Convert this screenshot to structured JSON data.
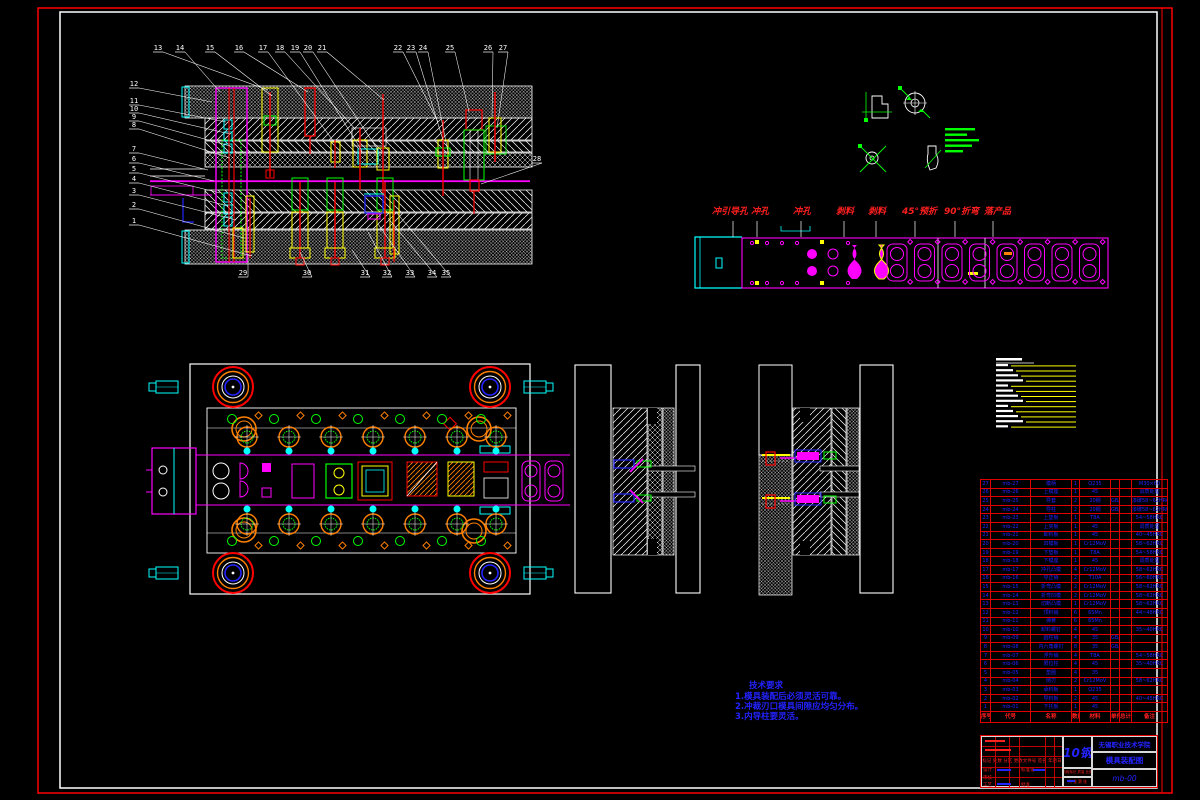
{
  "page": {
    "bg": "#000000",
    "border_color": "#ff0000",
    "frame_color": "#ffffff"
  },
  "colors": {
    "red": "#ff0000",
    "magenta": "#ff00ff",
    "cyan": "#00ffff",
    "green": "#00ff00",
    "yellow": "#ffff00",
    "blue": "#2323ff",
    "orange": "#ff8000",
    "white": "#ffffff"
  },
  "annotations": {
    "balloons": [
      {
        "n": "13",
        "x": 158,
        "y": 50,
        "tx": 268,
        "ty": 90
      },
      {
        "n": "14",
        "x": 180,
        "y": 50,
        "tx": 220,
        "ty": 92
      },
      {
        "n": "15",
        "x": 210,
        "y": 50,
        "tx": 272,
        "ty": 96
      },
      {
        "n": "16",
        "x": 239,
        "y": 50,
        "tx": 308,
        "ty": 92
      },
      {
        "n": "17",
        "x": 263,
        "y": 50,
        "tx": 334,
        "ty": 142
      },
      {
        "n": "18",
        "x": 280,
        "y": 50,
        "tx": 356,
        "ty": 130
      },
      {
        "n": "19",
        "x": 295,
        "y": 50,
        "tx": 362,
        "ty": 151
      },
      {
        "n": "20",
        "x": 308,
        "y": 50,
        "tx": 378,
        "ty": 150
      },
      {
        "n": "21",
        "x": 322,
        "y": 50,
        "tx": 384,
        "ty": 100
      },
      {
        "n": "22",
        "x": 398,
        "y": 50,
        "tx": 438,
        "ty": 122
      },
      {
        "n": "23",
        "x": 411,
        "y": 50,
        "tx": 443,
        "ty": 140
      },
      {
        "n": "24",
        "x": 423,
        "y": 50,
        "tx": 448,
        "ty": 152
      },
      {
        "n": "25",
        "x": 450,
        "y": 50,
        "tx": 469,
        "ty": 112
      },
      {
        "n": "26",
        "x": 488,
        "y": 50,
        "tx": 492,
        "ty": 118
      },
      {
        "n": "27",
        "x": 503,
        "y": 50,
        "tx": 497,
        "ty": 128
      },
      {
        "n": "28",
        "x": 537,
        "y": 161,
        "tx": 481,
        "ty": 184
      },
      {
        "n": "12",
        "x": 134,
        "y": 86,
        "tx": 212,
        "ty": 102
      },
      {
        "n": "11",
        "x": 134,
        "y": 103,
        "tx": 226,
        "ty": 122
      },
      {
        "n": "10",
        "x": 134,
        "y": 111,
        "tx": 230,
        "ty": 134
      },
      {
        "n": "9",
        "x": 134,
        "y": 119,
        "tx": 230,
        "ty": 146
      },
      {
        "n": "8",
        "x": 134,
        "y": 127,
        "tx": 230,
        "ty": 158
      },
      {
        "n": "7",
        "x": 134,
        "y": 151,
        "tx": 208,
        "ty": 170
      },
      {
        "n": "6",
        "x": 134,
        "y": 161,
        "tx": 214,
        "ty": 181
      },
      {
        "n": "5",
        "x": 134,
        "y": 171,
        "tx": 220,
        "ty": 193
      },
      {
        "n": "4",
        "x": 134,
        "y": 181,
        "tx": 228,
        "ty": 206
      },
      {
        "n": "3",
        "x": 134,
        "y": 193,
        "tx": 236,
        "ty": 220
      },
      {
        "n": "2",
        "x": 134,
        "y": 207,
        "tx": 244,
        "ty": 238
      },
      {
        "n": "1",
        "x": 134,
        "y": 223,
        "tx": 252,
        "ty": 256
      },
      {
        "n": "29",
        "x": 243,
        "y": 275,
        "tx": 248,
        "ty": 254
      },
      {
        "n": "30",
        "x": 307,
        "y": 275,
        "tx": 300,
        "ty": 252
      },
      {
        "n": "31",
        "x": 365,
        "y": 275,
        "tx": 352,
        "ty": 250
      },
      {
        "n": "32",
        "x": 387,
        "y": 275,
        "tx": 368,
        "ty": 232
      },
      {
        "n": "33",
        "x": 410,
        "y": 275,
        "tx": 378,
        "ty": 224
      },
      {
        "n": "34",
        "x": 432,
        "y": 275,
        "tx": 388,
        "ty": 218
      },
      {
        "n": "35",
        "x": 446,
        "y": 275,
        "tx": 396,
        "ty": 212
      }
    ],
    "strip_labels": [
      {
        "text": "冲引导孔 冲孔",
        "x": 712,
        "lx": 757
      },
      {
        "text": "冲孔",
        "x": 793,
        "lx": 801
      },
      {
        "text": "剥料",
        "x": 836,
        "lx": 844
      },
      {
        "text": "剥料",
        "x": 868,
        "lx": 876
      },
      {
        "text": "45°预折",
        "x": 902,
        "lx": 915
      },
      {
        "text": "90°折弯",
        "x": 944,
        "lx": 955
      },
      {
        "text": "落产品",
        "x": 984,
        "lx": 993
      }
    ],
    "notes": {
      "title": "技术要求",
      "lines": [
        "1.模具装配后必须灵活可靠。",
        "2.冲裁刃口模具间隙应均匀分布。",
        "3.内导柱要灵活。"
      ]
    }
  },
  "legend": {
    "row_count": 13
  },
  "bom": {
    "headers": [
      "序号",
      "代号",
      "名称",
      "数量",
      "材料",
      "单件",
      "总计",
      "备注"
    ],
    "rows": [
      [
        "27",
        "mb-27",
        "模柄",
        "1",
        "Q235",
        "",
        "",
        "M30×60"
      ],
      [
        "26",
        "mb-26",
        "上模座",
        "1",
        "45",
        "",
        "",
        "调质处理"
      ],
      [
        "25",
        "mb-25",
        "导套",
        "2",
        "20钢",
        "GB/T 2861",
        "",
        "渗碳58~62HRC"
      ],
      [
        "24",
        "mb-24",
        "导柱",
        "2",
        "20钢",
        "GB/T 2861",
        "",
        "渗碳58~62HRC"
      ],
      [
        "23",
        "mb-23",
        "上垫板",
        "1",
        "T8A",
        "",
        "",
        "54~58HRC"
      ],
      [
        "22",
        "mb-22",
        "上夹板",
        "1",
        "45",
        "",
        "",
        "调质处理"
      ],
      [
        "21",
        "mb-21",
        "卸料板",
        "1",
        "45",
        "",
        "",
        "40~45HRC"
      ],
      [
        "20",
        "mb-20",
        "凹模板",
        "1",
        "Cr12MoV",
        "",
        "",
        "58~62HRC"
      ],
      [
        "19",
        "mb-19",
        "下垫板",
        "1",
        "T8A",
        "",
        "",
        "54~58HRC"
      ],
      [
        "18",
        "mb-18",
        "下模座",
        "1",
        "45",
        "",
        "",
        "调质处理"
      ],
      [
        "17",
        "mb-17",
        "冲孔凸模",
        "4",
        "Cr12MoV",
        "",
        "",
        "58~62HRC"
      ],
      [
        "16",
        "mb-16",
        "导正销",
        "2",
        "T10A",
        "",
        "",
        "56~60HRC"
      ],
      [
        "15",
        "mb-15",
        "折弯凸模",
        "2",
        "Cr12MoV",
        "",
        "",
        "58~62HRC"
      ],
      [
        "14",
        "mb-14",
        "折弯凹模",
        "2",
        "Cr12MoV",
        "",
        "",
        "58~62HRC"
      ],
      [
        "13",
        "mb-13",
        "切断凸模",
        "1",
        "Cr12MoV",
        "",
        "",
        "58~62HRC"
      ],
      [
        "12",
        "mb-12",
        "顶料销",
        "6",
        "65Mn",
        "",
        "",
        "44~48HRC"
      ],
      [
        "11",
        "mb-11",
        "弹簧",
        "6",
        "65Mn",
        "",
        "",
        ""
      ],
      [
        "10",
        "mb-10",
        "卸料螺钉",
        "4",
        "45",
        "",
        "",
        "35~40HRC"
      ],
      [
        "9",
        "mb-09",
        "圆柱销",
        "4",
        "35",
        "GB/T 119.1",
        "",
        ""
      ],
      [
        "8",
        "mb-08",
        "内六角螺钉",
        "8",
        "35",
        "GB/T 70.1",
        "",
        ""
      ],
      [
        "7",
        "mb-07",
        "浮升销",
        "4",
        "T8A",
        "",
        "",
        "54~58HRC"
      ],
      [
        "6",
        "mb-06",
        "限位柱",
        "4",
        "45",
        "",
        "",
        "35~40HRC"
      ],
      [
        "5",
        "mb-05",
        "垫圈",
        "4",
        "35",
        "",
        "",
        ""
      ],
      [
        "4",
        "mb-04",
        "侧刃",
        "2",
        "Cr12MoV",
        "",
        "",
        "58~62HRC"
      ],
      [
        "3",
        "mb-03",
        "承料板",
        "1",
        "Q235",
        "",
        "",
        ""
      ],
      [
        "2",
        "mb-02",
        "导料板",
        "2",
        "45",
        "",
        "",
        "40~45HRC"
      ],
      [
        "1",
        "mb-01",
        "下托板",
        "1",
        "45",
        "",
        "",
        ""
      ]
    ]
  },
  "title_block": {
    "material_big": "10钢",
    "org": "无锡职业技术学院",
    "drawing_title": "模具装配图",
    "drawing_no": "mb-00",
    "mark_row": "标记 处数 分区 更改文件号 签名 年月日",
    "role_design": "设计",
    "role_std": "标准化",
    "role_check": "审核",
    "role_proc": "工艺",
    "role_appr": "批准",
    "stage": [
      "阶段标记",
      "质量",
      "比例"
    ],
    "sheet": "共 张 第 张"
  }
}
